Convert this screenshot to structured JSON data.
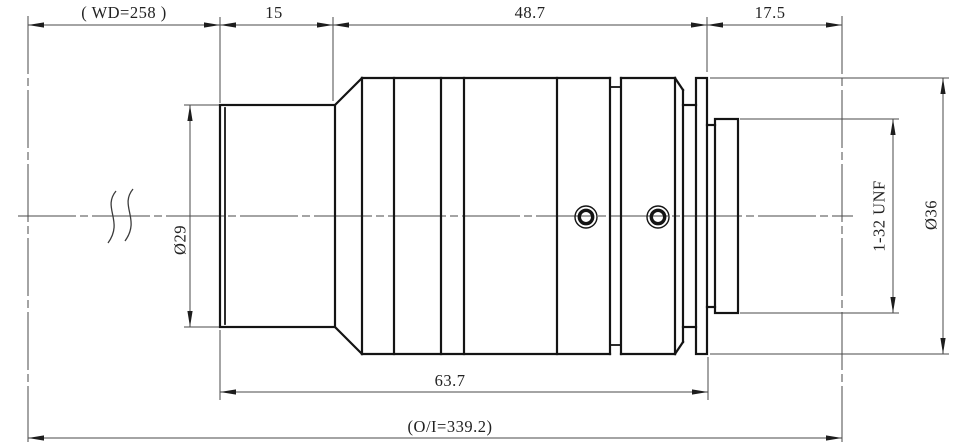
{
  "drawing": {
    "kind": "lens-outline-dimension-drawing",
    "colors": {
      "object_line": "#141414",
      "dimension_line": "#4a4a4a",
      "text": "#222222",
      "background": "#ffffff"
    },
    "dims": {
      "working_distance": "( WD=258 )",
      "front_length": "15",
      "mid_length": "48.7",
      "flange_focal": "17.5",
      "body_length": "63.7",
      "object_image": "(O/I=339.2)",
      "front_diameter": "Ø29",
      "thread_spec": "1-32 UNF",
      "body_diameter": "Ø36"
    }
  }
}
